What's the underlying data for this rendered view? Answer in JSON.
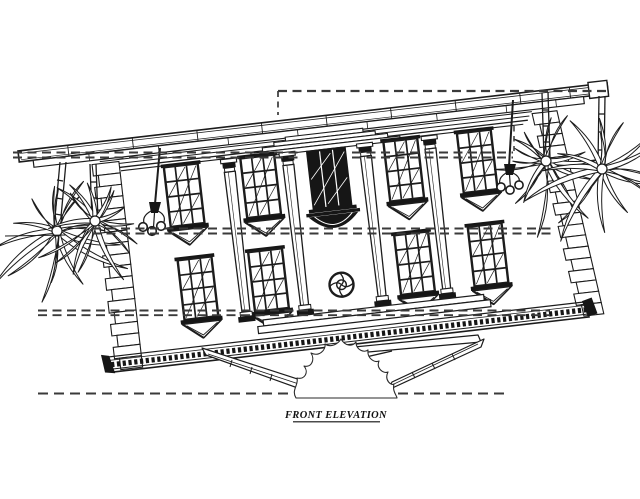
{
  "page": {
    "background": "#ffffff",
    "width": 640,
    "height": 499
  },
  "palette": {
    "ink": "#1c1c1c",
    "datum_line": "#3a3a3a",
    "paper": "#ffffff",
    "dark_fill": "#161616"
  },
  "title_block": {
    "label": "FRONT ELEVATION",
    "underlined": true
  },
  "drawing": {
    "type": "architectural-elevation",
    "elements": [
      "eave-cornice",
      "fascia-band",
      "frieze-entablature",
      "corner-quoins",
      "giant-order-columns",
      "grille-windows-with-keel-sills",
      "center-balcony-window",
      "rosette-medallion",
      "beaded-base-course",
      "porch-steps",
      "stair-railings",
      "shrub-outline",
      "palm-trees",
      "hanging-lanterns",
      "datum-lines",
      "ground-line"
    ],
    "counts": {
      "columns": 4,
      "upper_windows": 4,
      "lower_windows": 4,
      "palm_clusters": 4,
      "lanterns": 2,
      "datum_levels": 5
    }
  }
}
